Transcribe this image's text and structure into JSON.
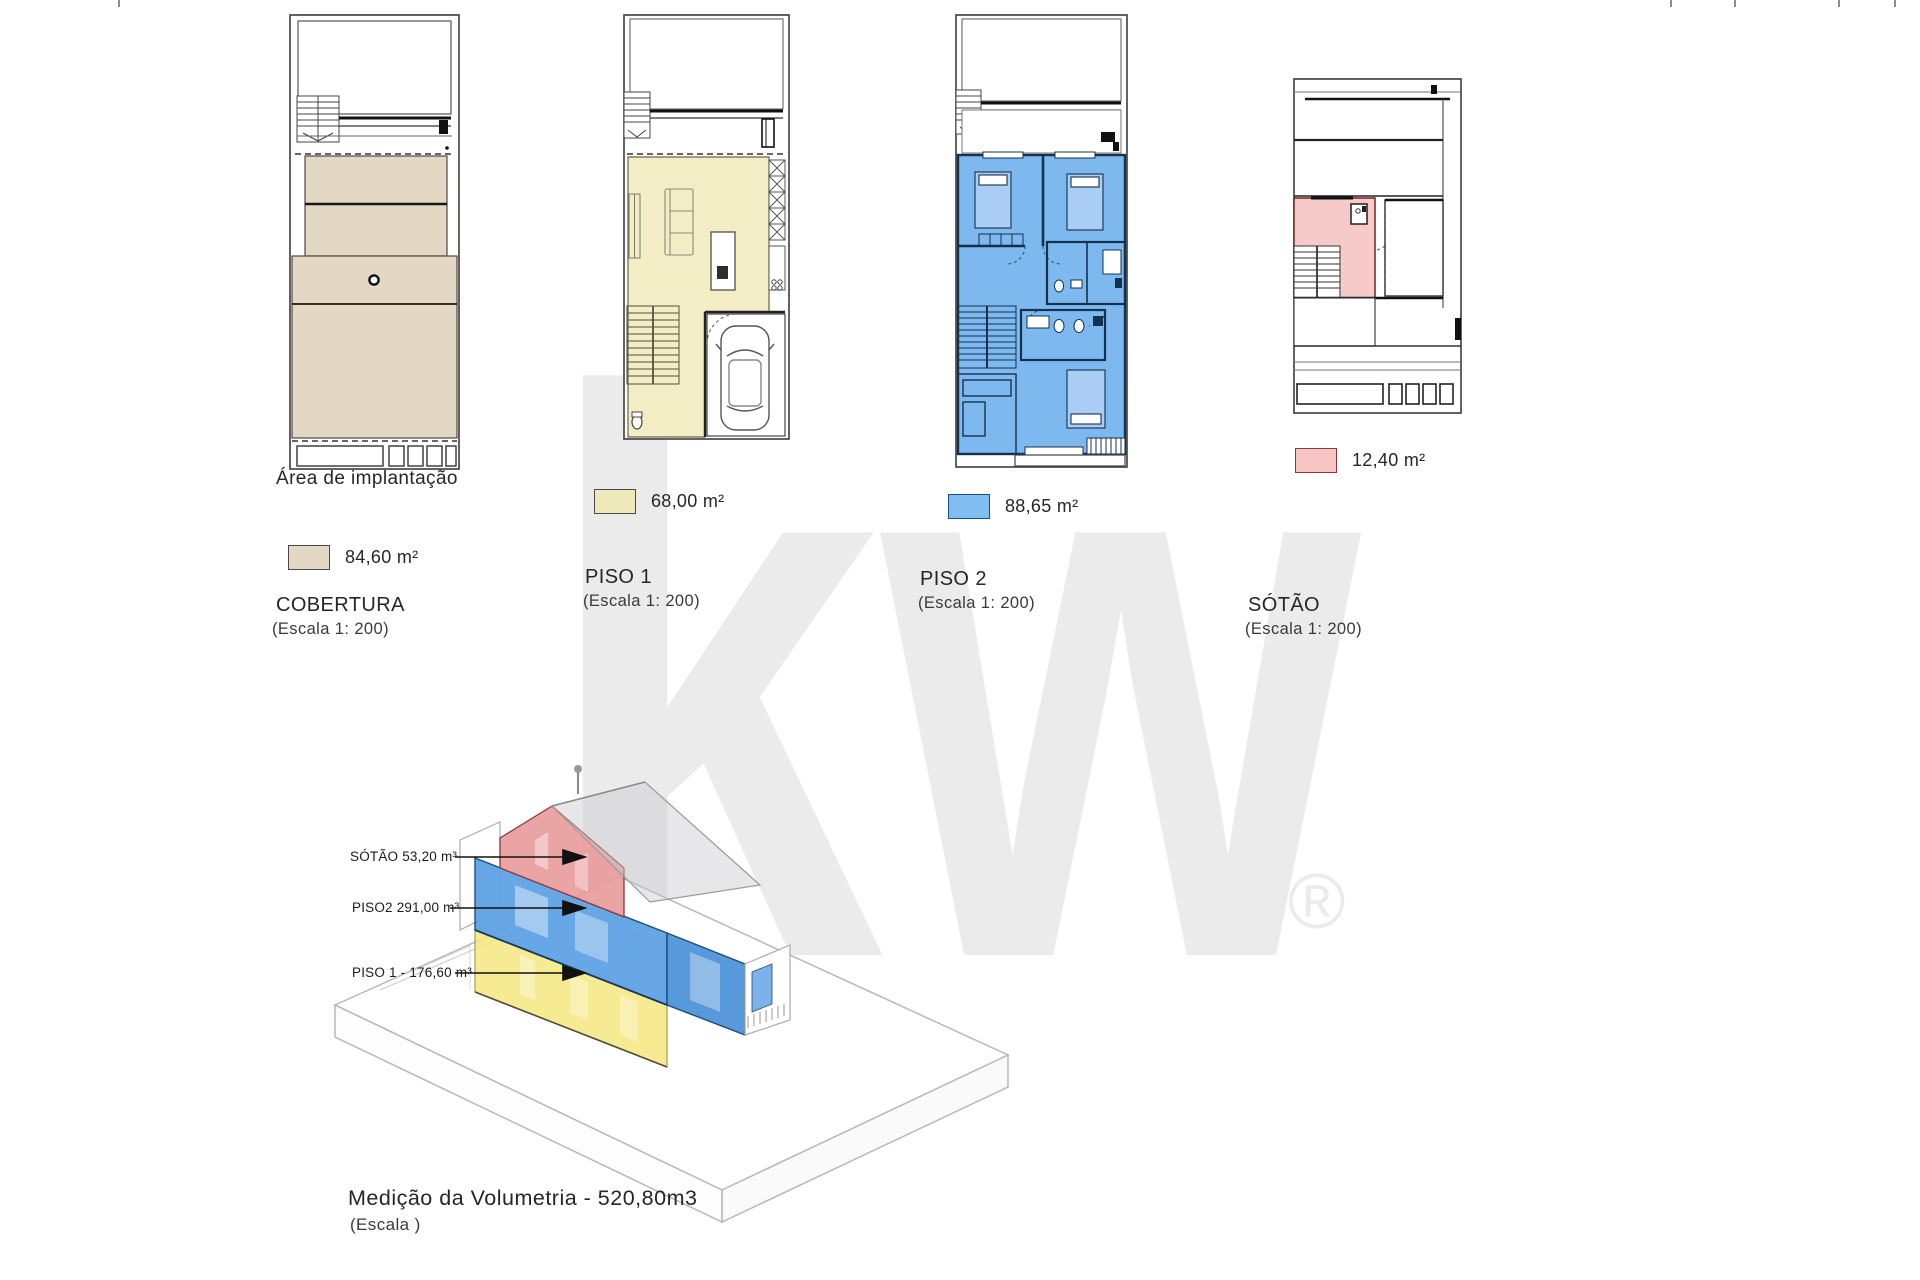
{
  "watermark": {
    "text": "kw",
    "registered": "®",
    "color": "#ebebeb"
  },
  "colors": {
    "tan": "#e4d7c3",
    "yellow": "#f3edc5",
    "yellowswatch": "#efe9ba",
    "blue": "#7db9ee",
    "bluedark": "#16395c",
    "bedblue": "#a9cdf4",
    "pink": "#f7caca",
    "pinkdark": "#7a2e2e",
    "axyellow": "#f5e87f",
    "axblue": "#5b9fe3",
    "axpink": "#e89a9a",
    "watermark": "#ebebeb"
  },
  "plans": [
    {
      "name": "cobertura",
      "area_label": "Área de implantação",
      "area_value": "84,60 m²",
      "title": "COBERTURA",
      "scale": "(Escala 1: 200)",
      "swatch_color": "#e4d7c3"
    },
    {
      "name": "piso1",
      "area_value": "68,00 m²",
      "title": "PISO 1",
      "scale": "(Escala 1: 200)",
      "swatch_color": "#efe9ba"
    },
    {
      "name": "piso2",
      "area_value": "88,65 m²",
      "title": "PISO 2",
      "scale": "(Escala 1: 200)",
      "swatch_color": "#80bdf2"
    },
    {
      "name": "sotao",
      "area_value": "12,40 m²",
      "title": "SÓTÃO",
      "scale": "(Escala 1: 200)",
      "swatch_color": "#f8c5c5"
    }
  ],
  "axonometric": {
    "labels": [
      {
        "text": "SÓTÃO 53,20 m³"
      },
      {
        "text": "PISO2 291,00 m³"
      },
      {
        "text": "PISO 1 -  176,60 m³"
      }
    ],
    "caption": "Medição da Volumetria - 520,80m3",
    "caption_scale": "(Escala  )"
  }
}
